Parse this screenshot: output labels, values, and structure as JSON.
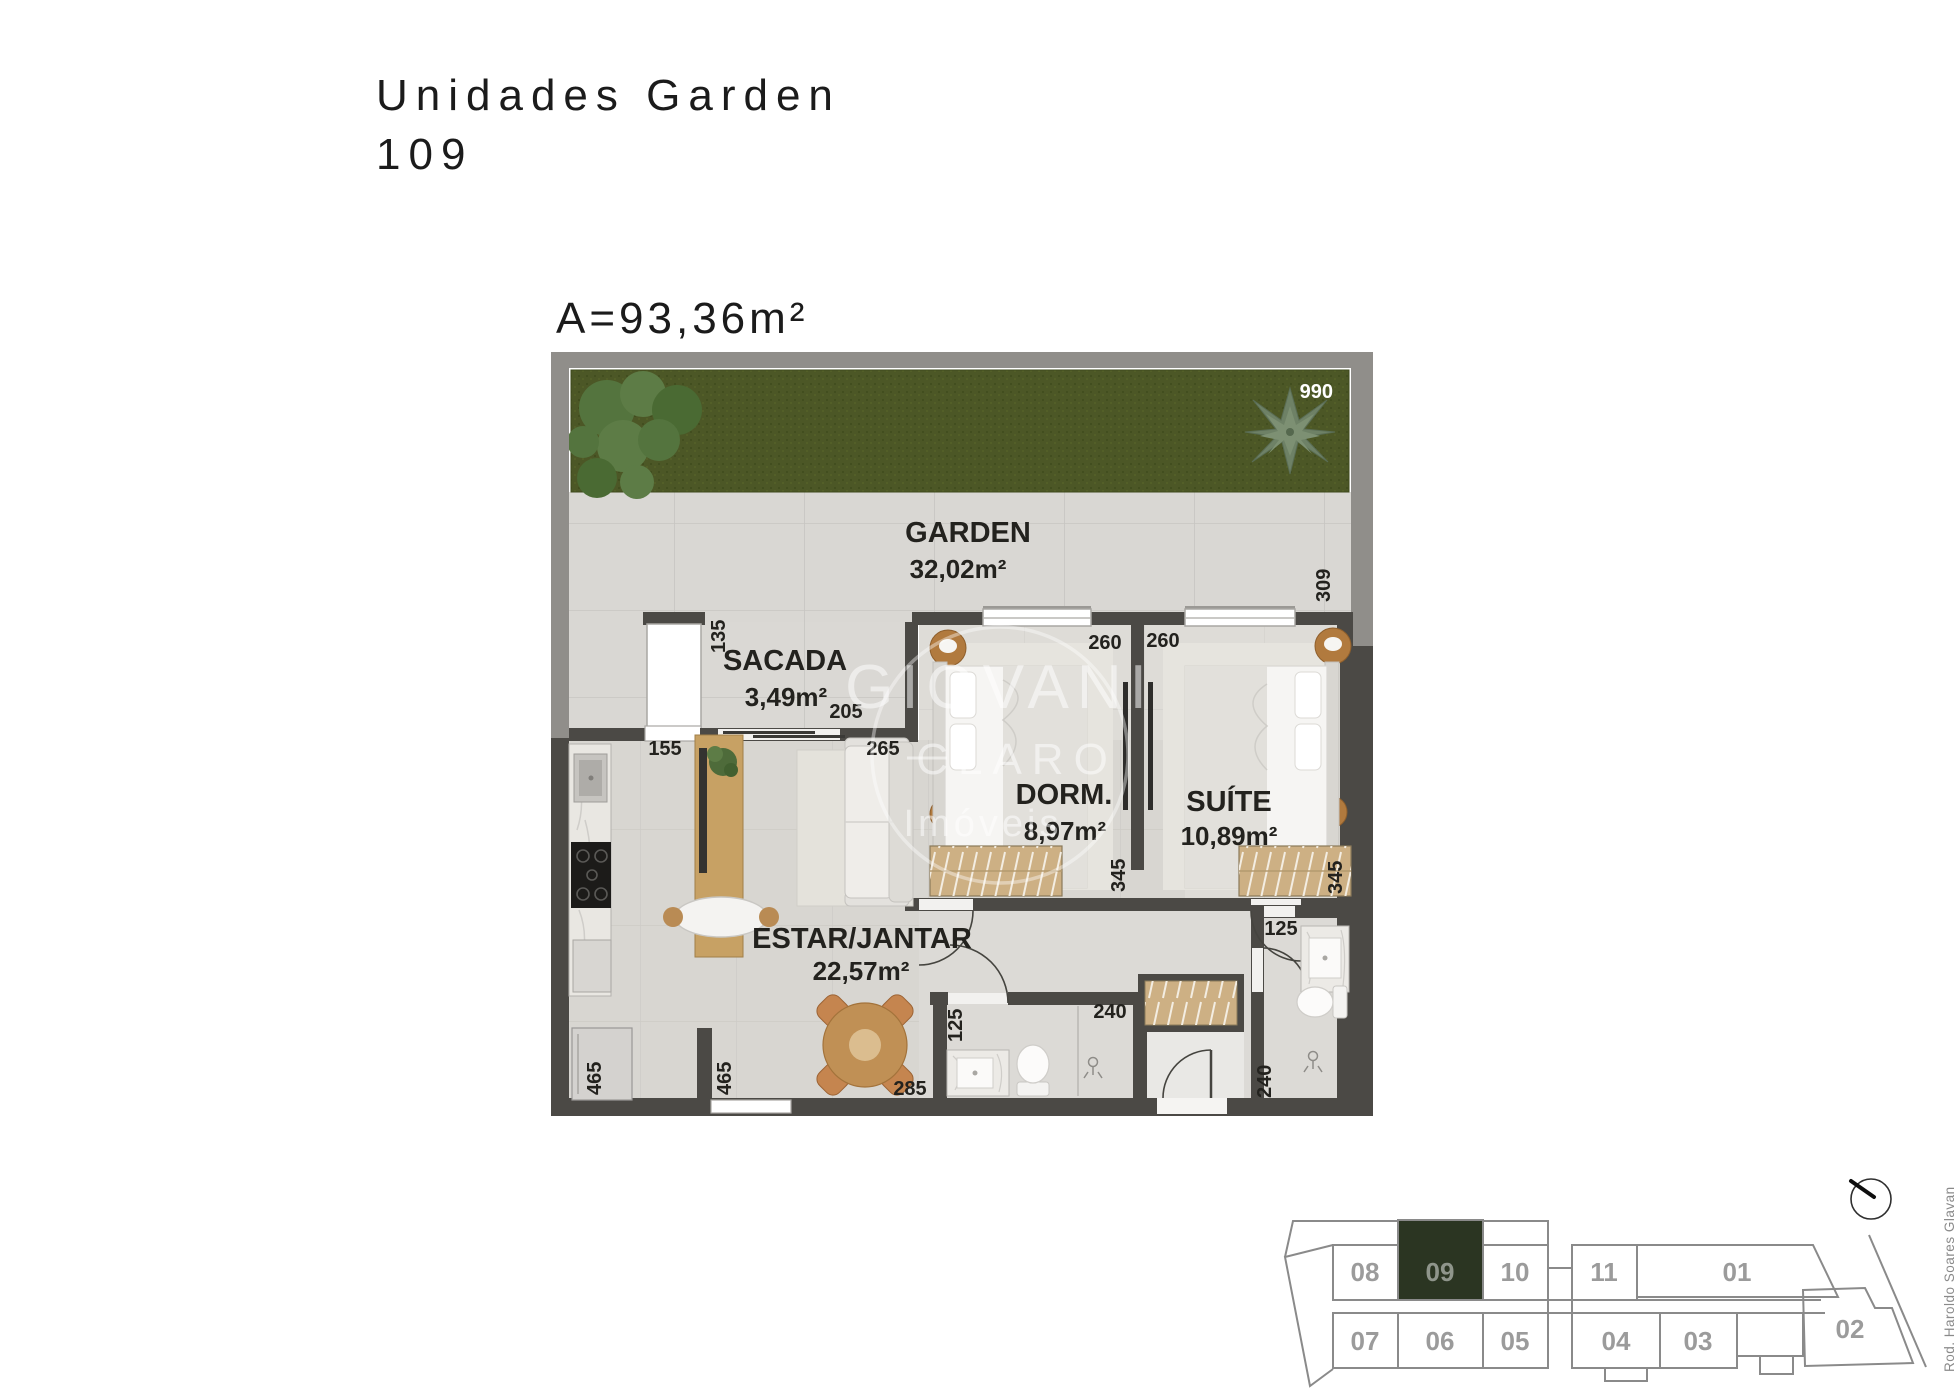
{
  "title": {
    "line1": "Unidades Garden",
    "line2": "109"
  },
  "area_label": "A=93,36m²",
  "plan": {
    "rooms": [
      {
        "name": "GARDEN",
        "area": "32,02m²"
      },
      {
        "name": "SACADA",
        "area": "3,49m²"
      },
      {
        "name": "DORM.",
        "area": "8,97m²"
      },
      {
        "name": "SUÍTE",
        "area": "10,89m²"
      },
      {
        "name": "ESTAR/JANTAR",
        "area": "22,57m²"
      }
    ],
    "dims": {
      "garden_width": "990",
      "garden_side": "309",
      "sacada_side": "135",
      "sacada_opening": "205",
      "kitchen_pass": "155",
      "estar_opening": "265",
      "dorm_width": "260",
      "suite_width": "260",
      "dorm_depth": "345",
      "suite_depth": "345",
      "bath_width": "125",
      "closet_width": "240",
      "suite_bath_width": "125",
      "suite_bath_depth": "240",
      "kitchen_wall": "465",
      "estar_wall": "465",
      "estar_window": "285"
    },
    "watermark": {
      "line1": "GIOVANI",
      "line2": "CLARO",
      "line3": "Imóveis"
    }
  },
  "keyplan": {
    "highlight": "09",
    "highlight_color": "#2b3522",
    "top_row": [
      "08",
      "09",
      "10",
      "11",
      "01"
    ],
    "bottom_row": [
      "07",
      "06",
      "05",
      "04",
      "03",
      "02"
    ],
    "road_label": "Rod. Haroldo Soares Glavan"
  },
  "colors": {
    "wall_dark": "#4b4945",
    "wall_outer": "#908e8a",
    "grass": "#4c5726",
    "floor_tile": "#d9d7d3",
    "wood": "#c7a164",
    "keyplan_line": "#8a8a8a",
    "label_text": "#23221e"
  }
}
